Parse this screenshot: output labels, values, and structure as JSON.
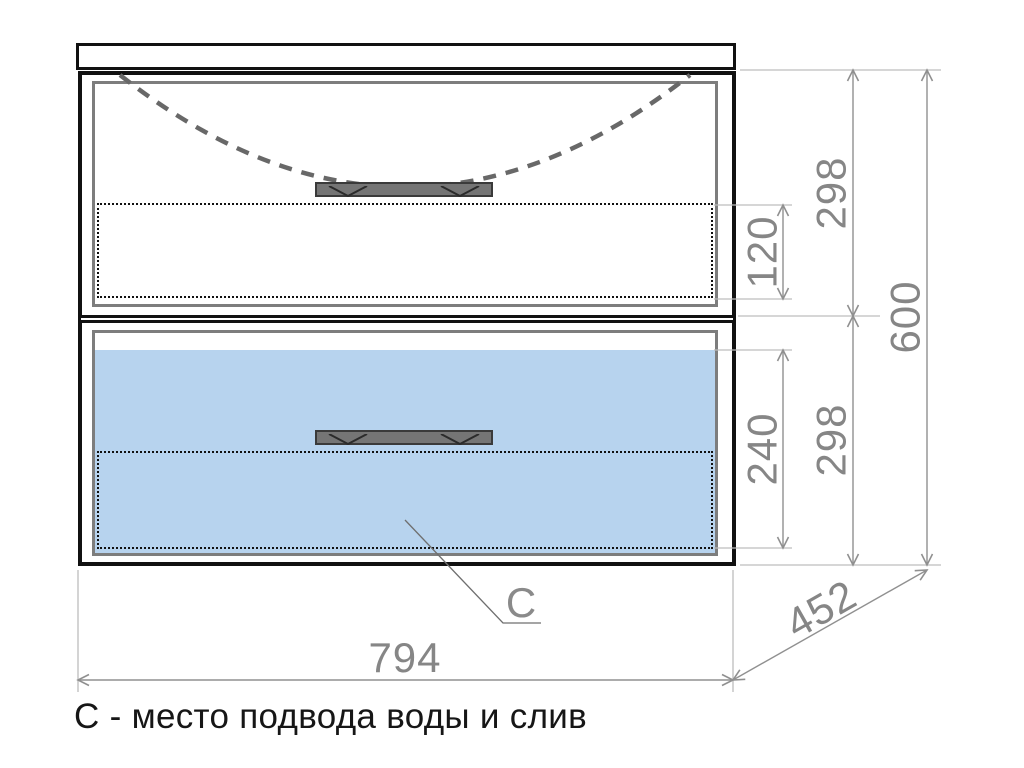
{
  "caption": "С - место подвода воды и слив",
  "drawing": {
    "connection_label": "C",
    "dimensions": {
      "overall_width": "794",
      "overall_depth": "452",
      "overall_height": "600",
      "top_section_height": "298",
      "bottom_section_height": "298",
      "top_inner_offset": "120",
      "bottom_inner_height": "240"
    }
  },
  "colors": {
    "outline-black": "#111111",
    "frame-gray": "#7d7d7d",
    "water-blue": "#b7d3ee",
    "dim-line": "#909090",
    "ext-line": "#bdbdbd",
    "dim-text": "#868686",
    "dash-gray": "#686868",
    "handle-fill": "#757575",
    "handle-border": "#3a3a3a",
    "caption-color": "#161616"
  }
}
